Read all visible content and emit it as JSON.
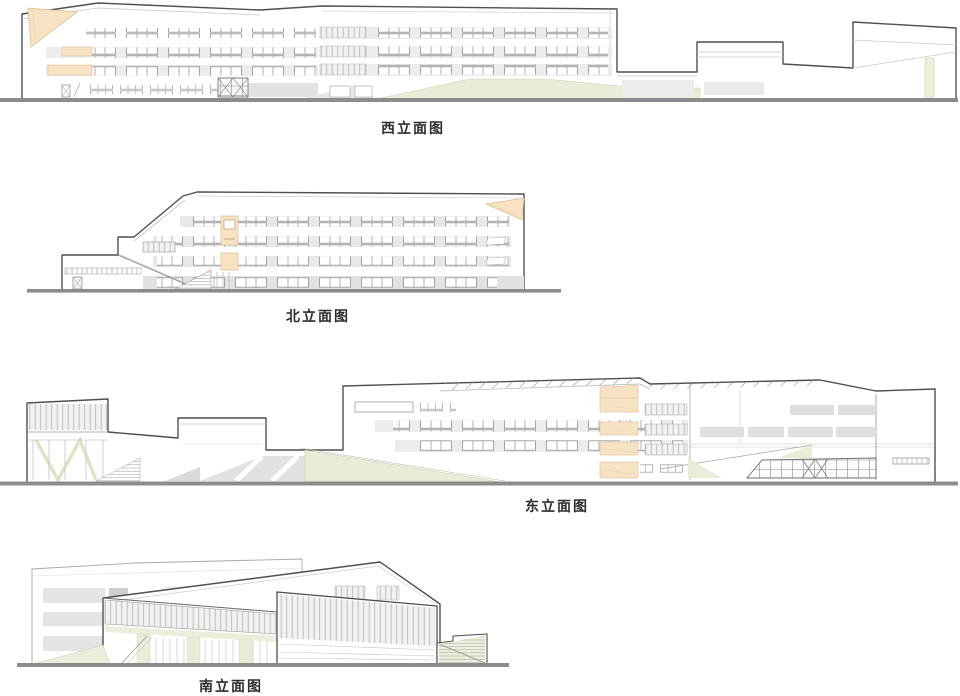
{
  "palette": {
    "outline": "#4f4f4f",
    "secondary_line": "#b5b5b5",
    "ground": "#8c8c8c",
    "accent_peach": "#f7e3c4",
    "accent_olive": "#e9ecd7",
    "band_gray": "#e9e9e9",
    "panel_gray": "#dedede"
  },
  "elevations": [
    {
      "id": "west",
      "label": "西立面图"
    },
    {
      "id": "north",
      "label": "北立面图"
    },
    {
      "id": "east",
      "label": "东立面图"
    },
    {
      "id": "south",
      "label": "南立面图"
    }
  ]
}
